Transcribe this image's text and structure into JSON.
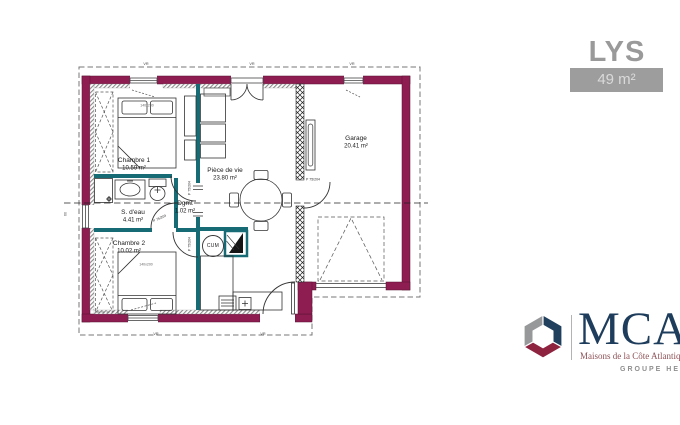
{
  "header": {
    "title": "LYS",
    "area_badge": "49 m²"
  },
  "plan": {
    "rooms": [
      {
        "name": "Chambre 1",
        "area": "10.59 m²"
      },
      {
        "name": "S. d'eau",
        "area": "4.41 m²"
      },
      {
        "name": "Dgmt",
        "area": "1.02 m²"
      },
      {
        "name": "Chambre 2",
        "area": "10.02 m²"
      },
      {
        "name": "Pièce de vie",
        "area": "23.80 m²"
      },
      {
        "name": "Garage",
        "area": "20.41 m²"
      }
    ],
    "labels": {
      "water_heater": "CUM",
      "door": "P 75/204",
      "bed": "140x200",
      "window": "VR",
      "dim": "60"
    },
    "colors": {
      "exterior_wall": "#8E1D52",
      "partition": "#166B74"
    }
  },
  "logo": {
    "brand": "MCA",
    "tagline": "Maisons de la Côte Atlantique",
    "group": "GROUPE HEXAÔM",
    "colors": {
      "navy": "#20405E",
      "red": "#8E2340",
      "gray": "#97989A"
    }
  }
}
